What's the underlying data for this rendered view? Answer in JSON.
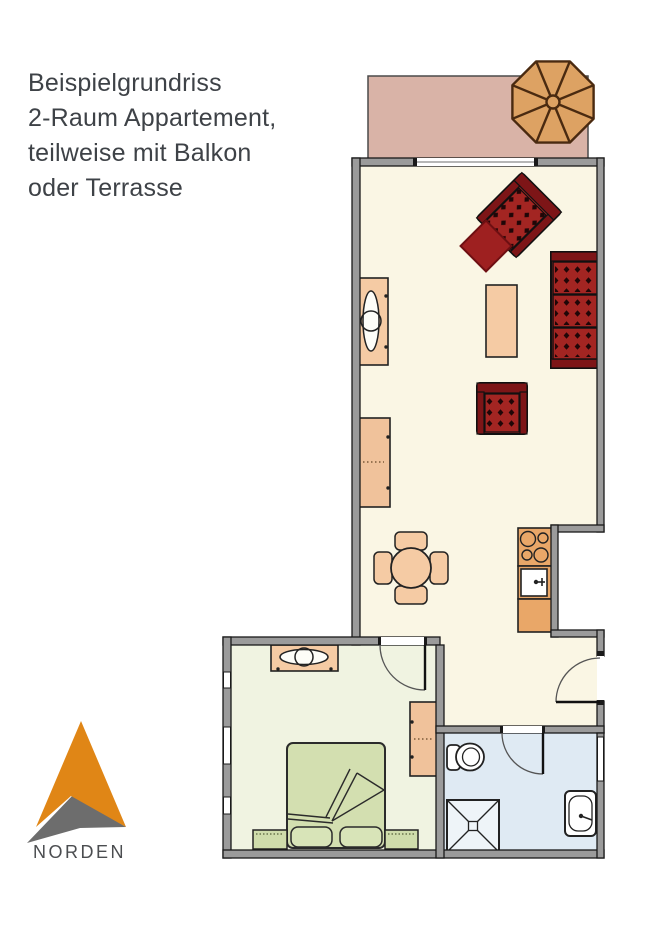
{
  "header": {
    "lines": [
      "Beispielgrundriss",
      "2-Raum Appartement,",
      "teilweise mit Balkon",
      "oder Terrasse"
    ]
  },
  "compass": {
    "label": "NORDEN"
  },
  "colors": {
    "wall_gray": "#9b9b9b",
    "wall_edge": "#1a1a1a",
    "living_floor": "#faf6e4",
    "bedroom_floor": "#f0f3e1",
    "bathroom_floor": "#dfeaf3",
    "balcony": "#d9b3a7",
    "umbrella": "#dda263",
    "umbrella_line": "#4a2a10",
    "red_furniture": "#a32522",
    "red_furniture_dark": "#7d1517",
    "wood_furniture": "#f5cba4",
    "kitchen_counter": "#e9a768",
    "bed_green": "#d3dfb0",
    "compass_orange": "#e08616",
    "compass_gray": "#6d6d6d",
    "title_text": "#3e4247"
  }
}
